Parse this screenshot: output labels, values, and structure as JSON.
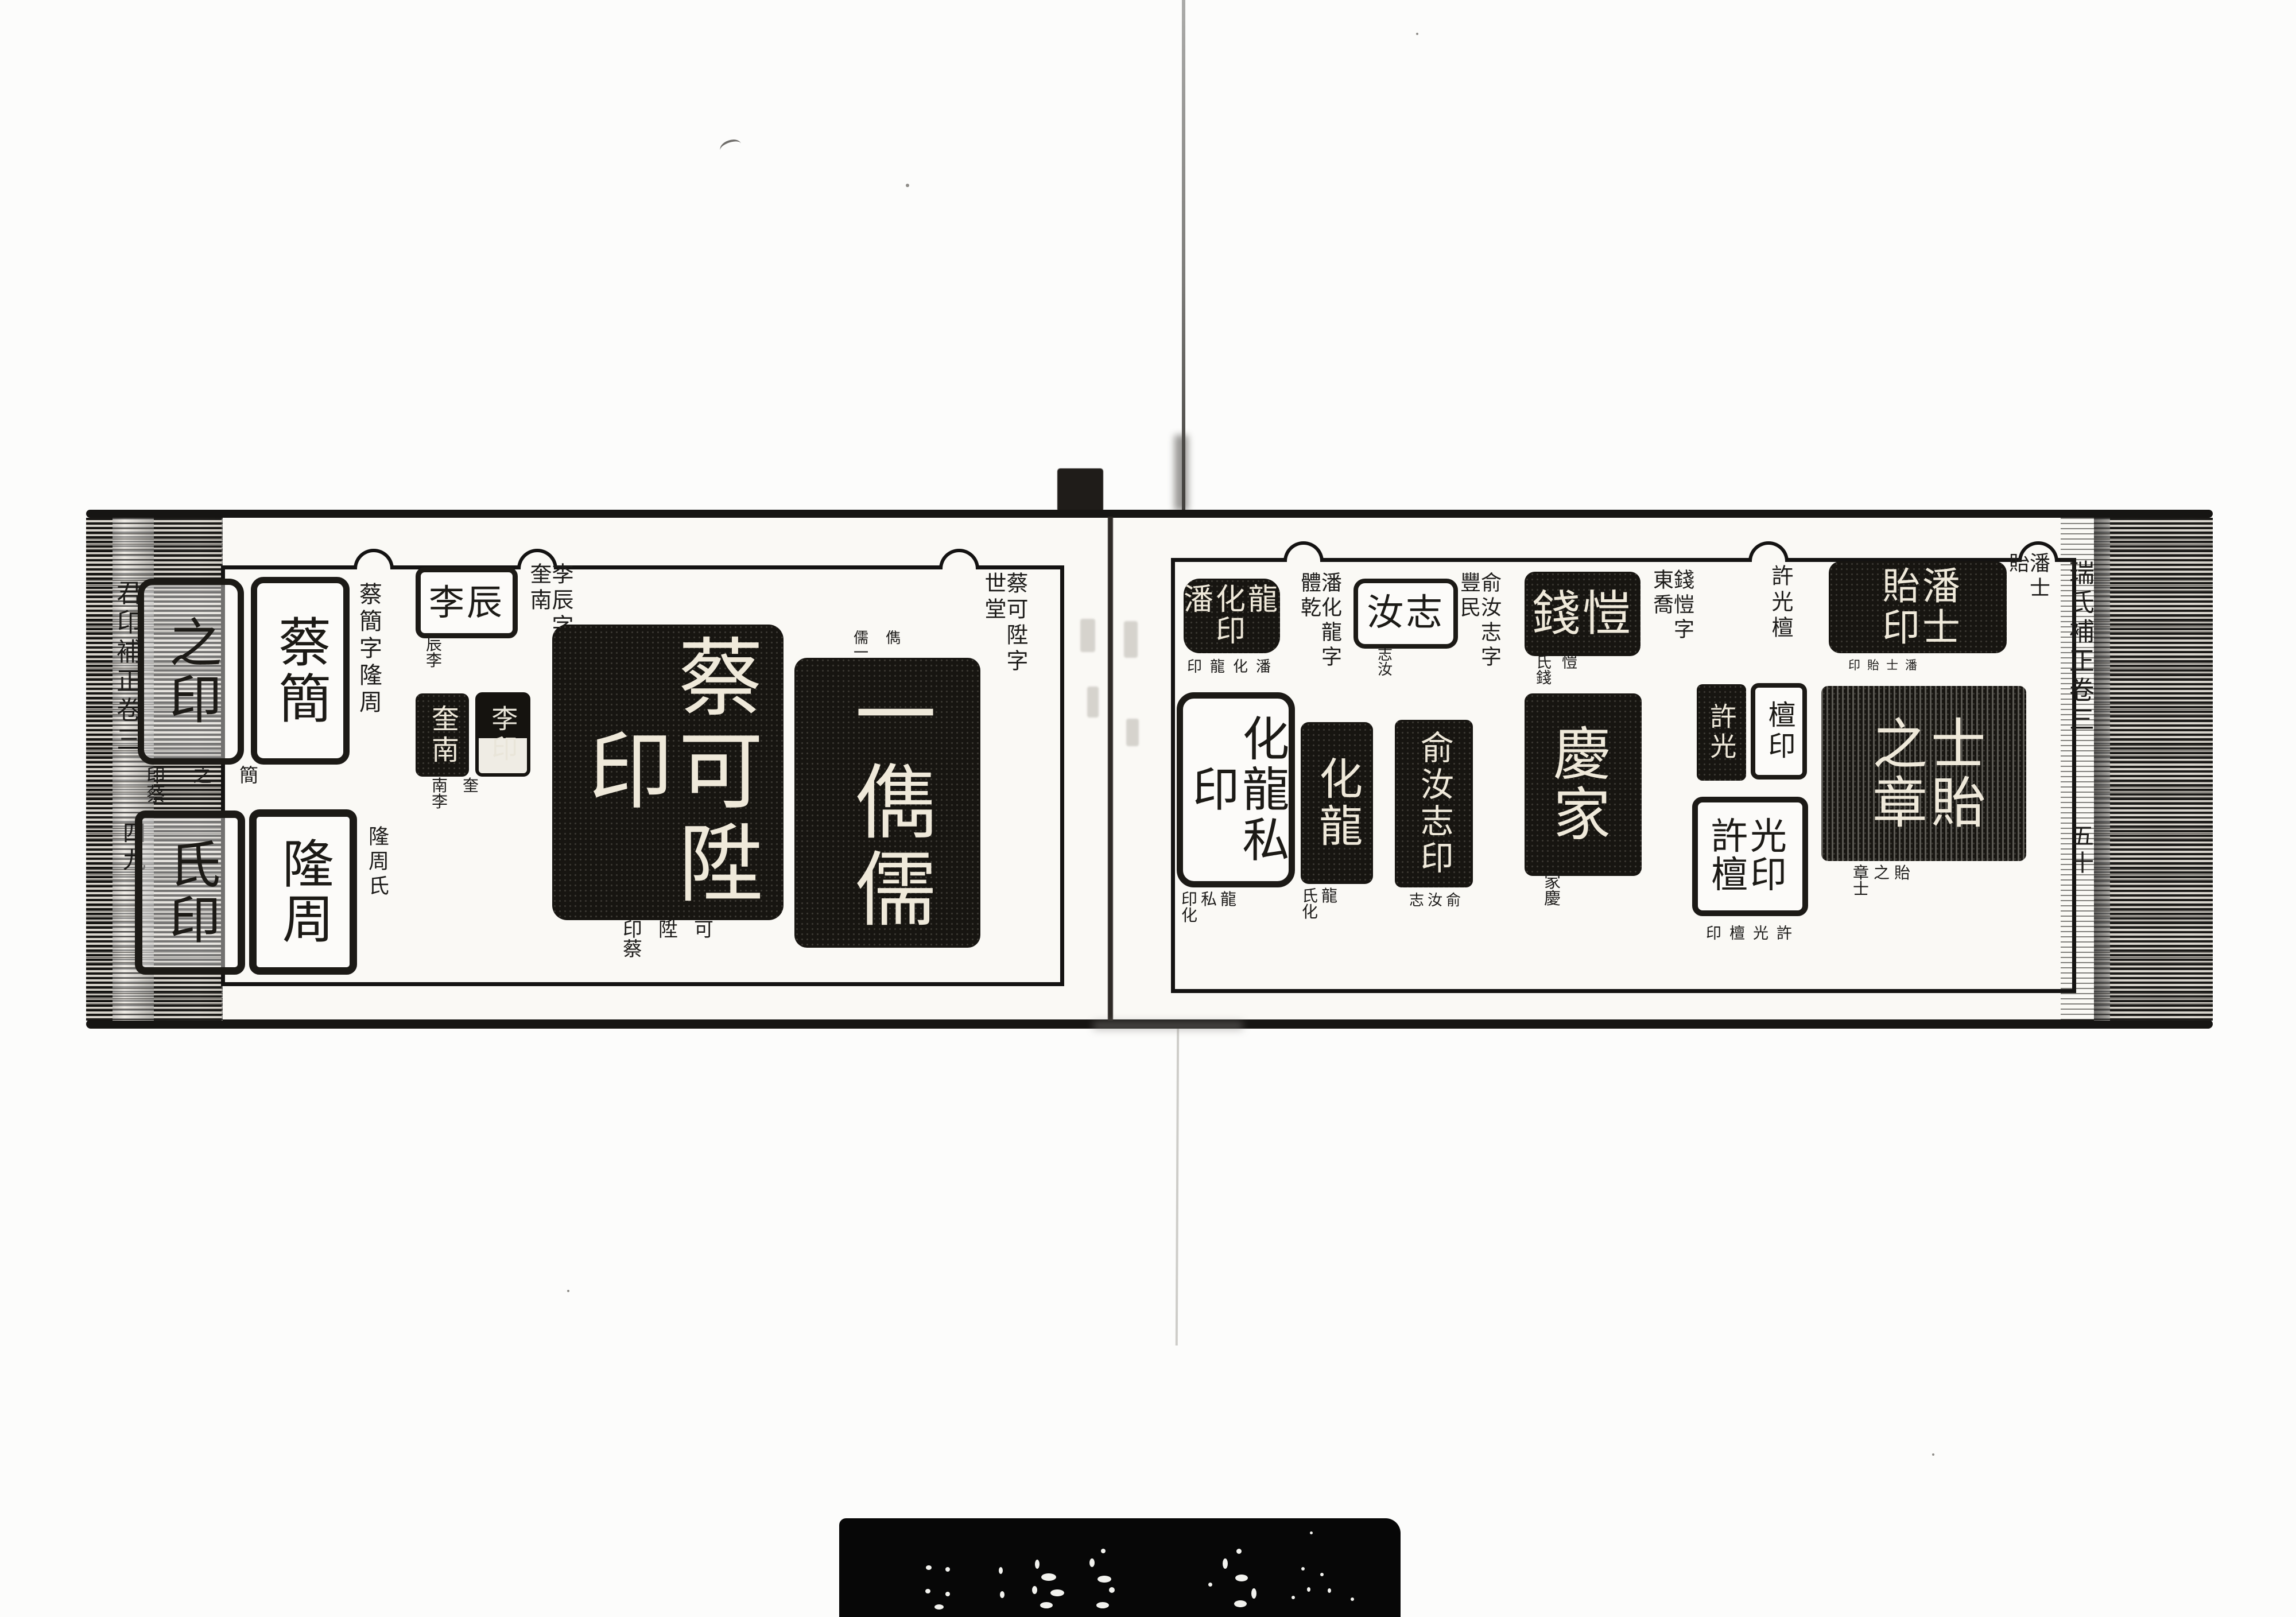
{
  "doc": {
    "description": "Scanned spread of a Chinese seal-impression catalogue (seal book), volume 3, leaf 49-50",
    "left_margin": {
      "title": "君卬補正卷三",
      "page_number": "四九"
    },
    "right_margin": {
      "title": "瑞氏補正卷三",
      "page_number": "五十"
    },
    "left_page": {
      "cai_jian": {
        "heading": "蔡簡字隆周",
        "seal_top_left": "之印",
        "seal_top_right": "蔡簡",
        "caption_mid": "印之簡蔡",
        "seal_bottom_left": "氏印",
        "seal_bottom_right": "隆周",
        "caption_side": "隆周氏"
      },
      "li_chen": {
        "heading": "李辰字奎南",
        "seal": "李辰",
        "caption": "辰李",
        "pair_left": "奎南",
        "pair_right": "李印",
        "pair_caption": "南奎李"
      },
      "cai_kesheng": {
        "heading": "蔡可陞字世堂",
        "big_seal": "蔡可陞印",
        "big_caption": "印陞可蔡",
        "label": "儒儁一",
        "dark_seal": "一儁儒"
      }
    },
    "right_page": {
      "pan_hualong": {
        "heading": "潘化龍字體乾",
        "seal1": "潘化龍印",
        "caption1": "印龍化潘",
        "seal2": "化龍私印",
        "caption2": "印私龍化",
        "seal3": "化龍",
        "caption3": "氏龍化"
      },
      "yu_ruzhi": {
        "heading": "俞汝志字豐民",
        "seal1": "汝志",
        "caption1": "志汝",
        "seal2": "俞汝志印",
        "caption2": "志汝俞"
      },
      "qian_kai": {
        "heading": "錢愷字東喬",
        "seal1": "錢愷",
        "caption1": "氏愷錢",
        "seal2": "慶家",
        "caption2": "家慶"
      },
      "xu_guangtan": {
        "heading": "許光檀",
        "pair_left": "許光",
        "pair_right": "檀印",
        "seal3": "許光檀印",
        "caption": "印檀光許"
      },
      "pan_shiyi": {
        "heading": "潘士貽",
        "seal1": "潘士貽印",
        "caption1": "印貽士潘",
        "seal2": "士貽之章",
        "caption2": "章之貽士"
      }
    }
  }
}
